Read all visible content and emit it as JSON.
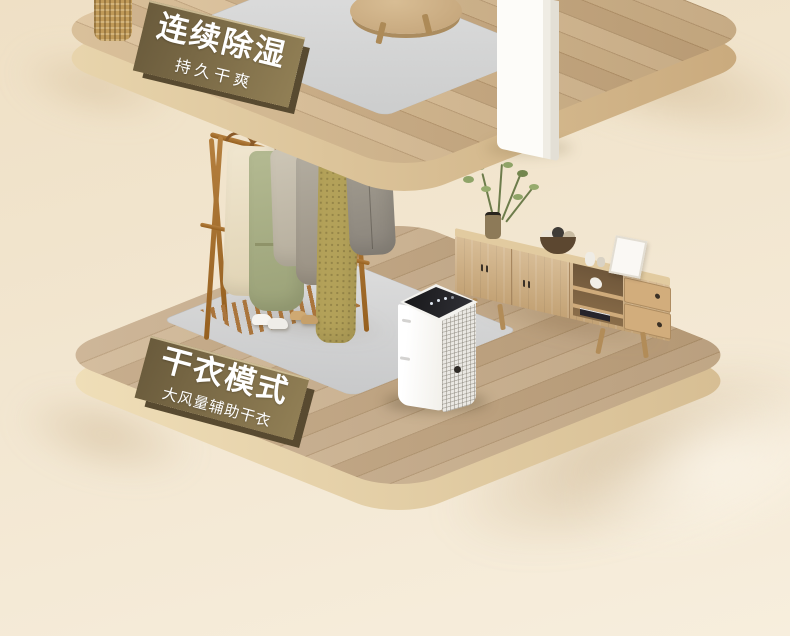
{
  "banners": {
    "upper": {
      "title": "连续除湿",
      "subtitle": "持久干爽"
    },
    "lower": {
      "title": "干衣模式",
      "subtitle": "大风量辅助干衣"
    }
  },
  "colors": {
    "background": "#f2e6d0",
    "floor_wood": "#c9af8e",
    "platform_edge": "#e8d5ae",
    "banner_plaque": "#7a6a46",
    "banner_text": "#ffffff",
    "rug": "#d6d6d7",
    "appliance_body": "#f7f6f2",
    "appliance_panel": "#1b1b1f",
    "cabinet_wood": "#cfae7f",
    "rack_wood": "#a9743a"
  },
  "objects": [
    "upper-wood-platform",
    "lower-wood-platform",
    "woven-basket",
    "coffee-table",
    "white-column",
    "upper-floor-rug",
    "clothes-rack",
    "hanging-garments",
    "area-rug",
    "sneakers",
    "slippers",
    "dehumidifier",
    "tv-cabinet",
    "potted-plant",
    "yarn-basket",
    "picture-frame",
    "books",
    "white-cup"
  ]
}
